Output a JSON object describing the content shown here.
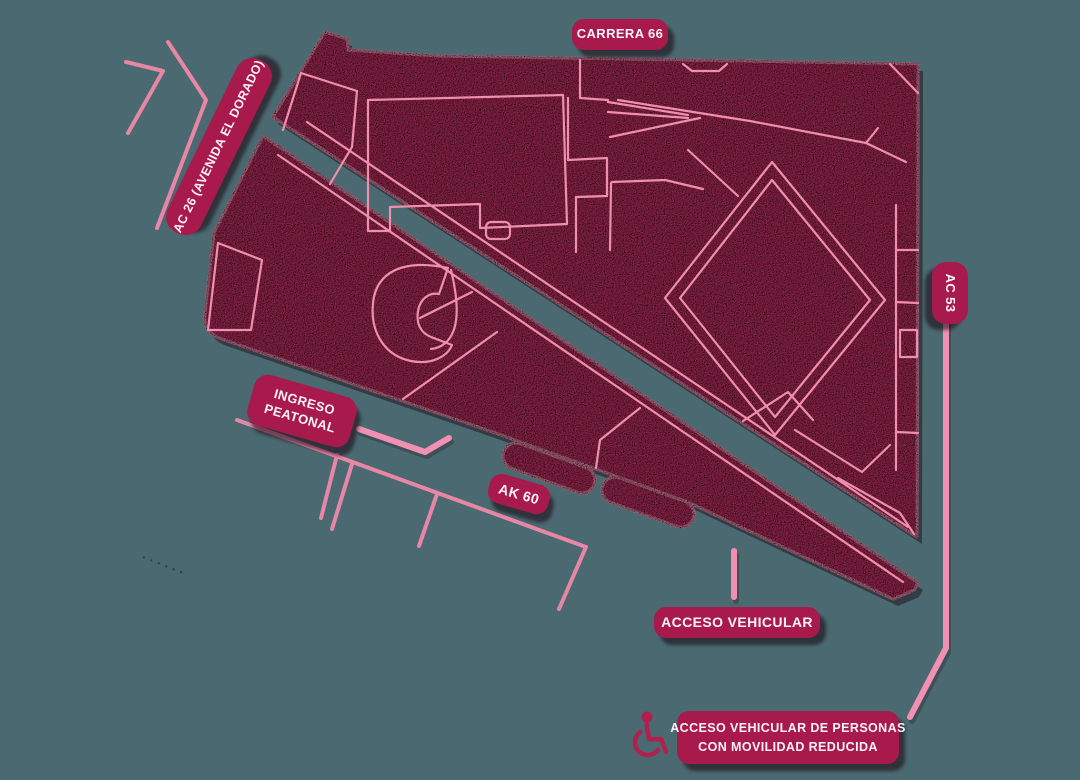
{
  "colors": {
    "bg": "#4A6970",
    "block": "#C93A6C",
    "outline": "#EE8FAD",
    "street": "#E886A6",
    "pointer": "#F290B3",
    "label_bg": "#A91A4C",
    "label_text": "#FCF3F6",
    "label_shadow": "rgba(28,5,16,0.55)",
    "block_shadow": "rgba(25,5,15,0.45)",
    "icon": "#B0204E"
  },
  "labels": {
    "carrera66": "CARRERA 66",
    "ac26": "AC 26 (AVENIDA EL DORADO)",
    "ac53": "AC 53",
    "ak60": "AK 60",
    "ingreso": {
      "lines": [
        "INGRESO",
        "PEATONAL"
      ]
    },
    "acceso_vehicular": "ACCESO VEHICULAR",
    "acceso_movilidad": {
      "lines": [
        "ACCESO VEHICULAR DE PERSONAS",
        "CON MOVILIDAD REDUCIDA"
      ],
      "icon": "wheelchair-icon"
    }
  }
}
